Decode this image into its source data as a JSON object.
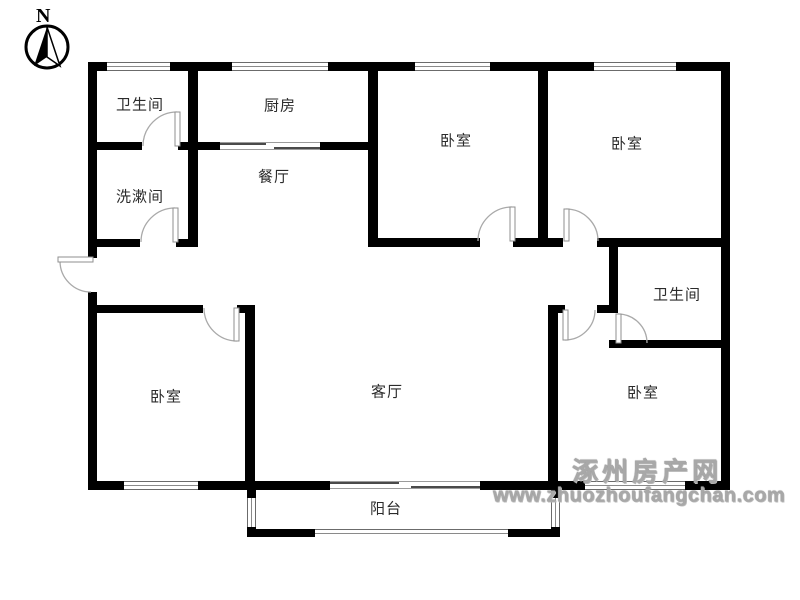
{
  "compass": {
    "label": "N"
  },
  "rooms": {
    "bathroom_top": {
      "label": "卫生间"
    },
    "washroom": {
      "label": "洗漱间"
    },
    "kitchen": {
      "label": "厨房"
    },
    "dining_room": {
      "label": "餐厅"
    },
    "bedroom_top_middle": {
      "label": "卧室"
    },
    "bedroom_top_right": {
      "label": "卧室"
    },
    "bathroom_right": {
      "label": "卫生间"
    },
    "bedroom_bottom_left": {
      "label": "卧室"
    },
    "living_room": {
      "label": "客厅"
    },
    "bedroom_bottom_right": {
      "label": "卧室"
    },
    "balcony": {
      "label": "阳台"
    }
  },
  "watermark": {
    "site_name": "涿州房产网",
    "site_url": "www.zhuozhoufangchan.com"
  },
  "colors": {
    "wall": "#000000",
    "door_arc": "#a9a9a9",
    "watermark_gray": "#a8a8a8",
    "label_text": "#2b2b2b"
  }
}
